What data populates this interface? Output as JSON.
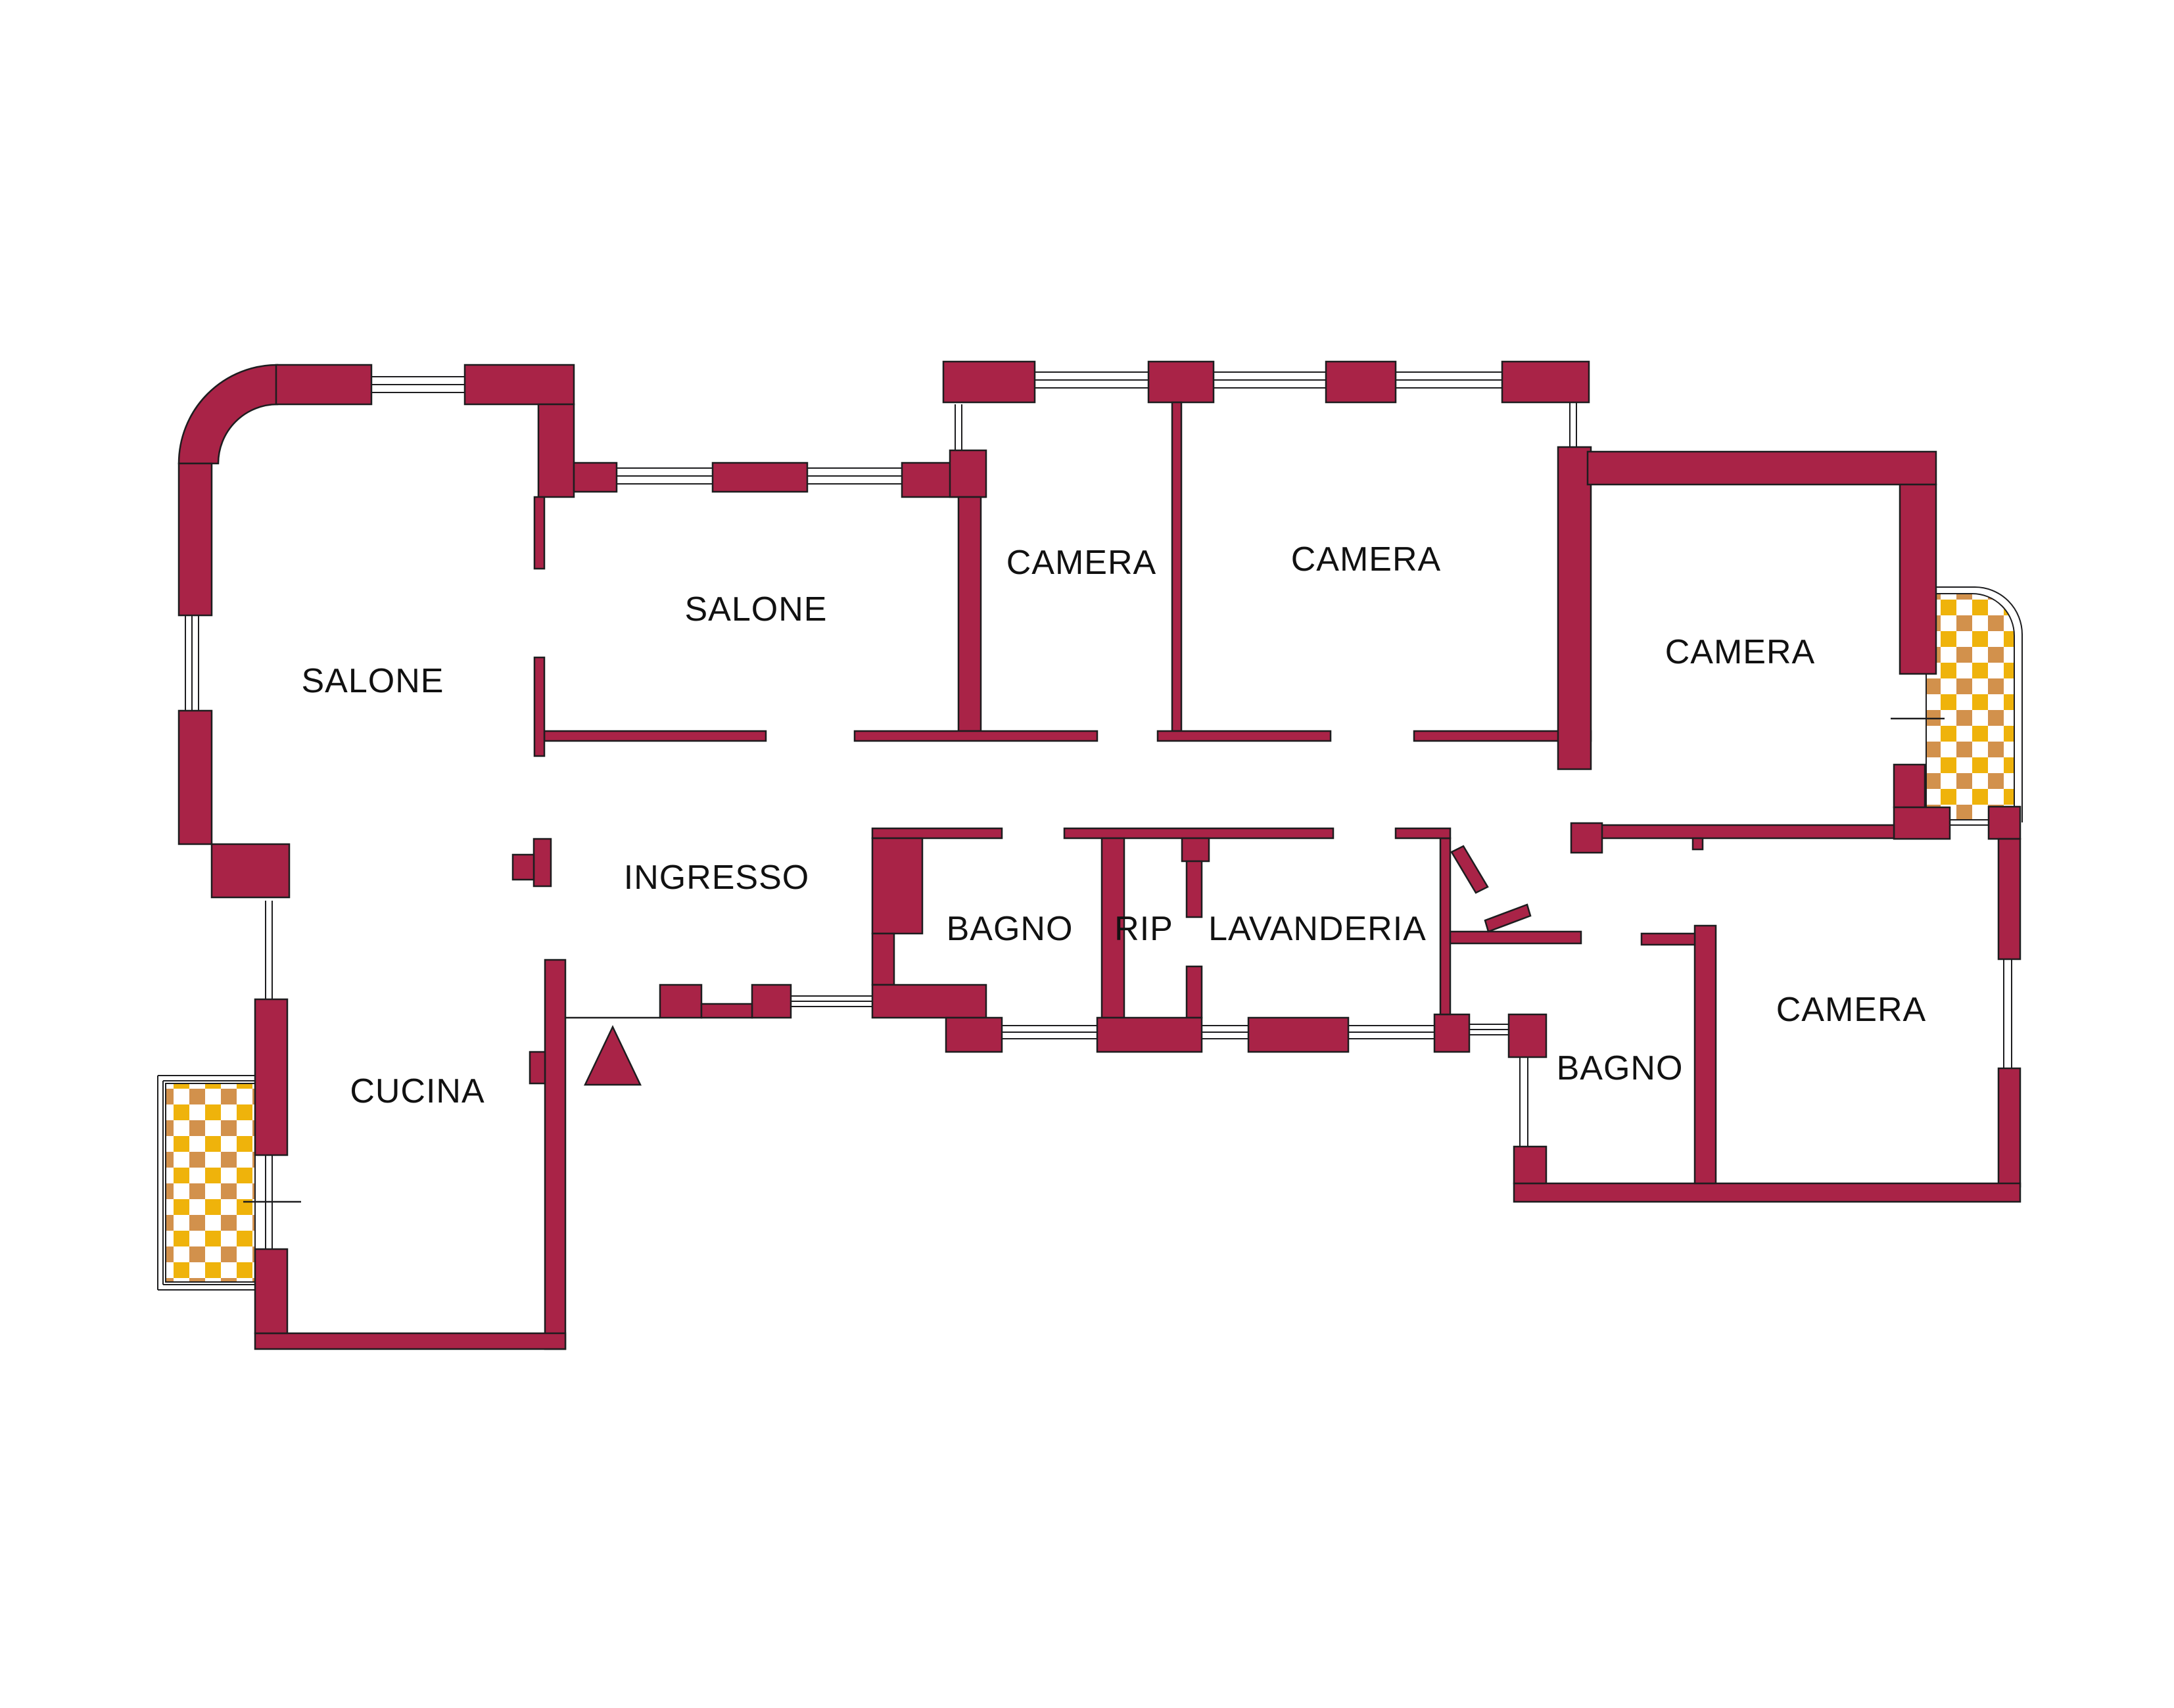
{
  "plan": {
    "type": "apartment-floor-plan",
    "language": "Italian"
  },
  "rooms": [
    {
      "id": "salone-1",
      "label": "SALONE"
    },
    {
      "id": "salone-2",
      "label": "SALONE"
    },
    {
      "id": "camera-1",
      "label": "CAMERA"
    },
    {
      "id": "camera-2",
      "label": "CAMERA"
    },
    {
      "id": "camera-3",
      "label": "CAMERA"
    },
    {
      "id": "camera-4",
      "label": "CAMERA"
    },
    {
      "id": "ingresso",
      "label": "INGRESSO"
    },
    {
      "id": "bagno-1",
      "label": "BAGNO"
    },
    {
      "id": "rip",
      "label": "RIP"
    },
    {
      "id": "lavanderia",
      "label": "LAVANDERIA"
    },
    {
      "id": "bagno-2",
      "label": "BAGNO"
    },
    {
      "id": "cucina",
      "label": "CUCINA"
    }
  ],
  "features": {
    "balconies": 2,
    "balcony_finish": "checkerboard tiles",
    "entrance_marker": "triangle"
  },
  "colors": {
    "wall": "#a92347",
    "checker_gold": "#efb30b",
    "checker_tan": "#d2914c",
    "outline": "#1d1d1f",
    "background": "#ffffff"
  }
}
